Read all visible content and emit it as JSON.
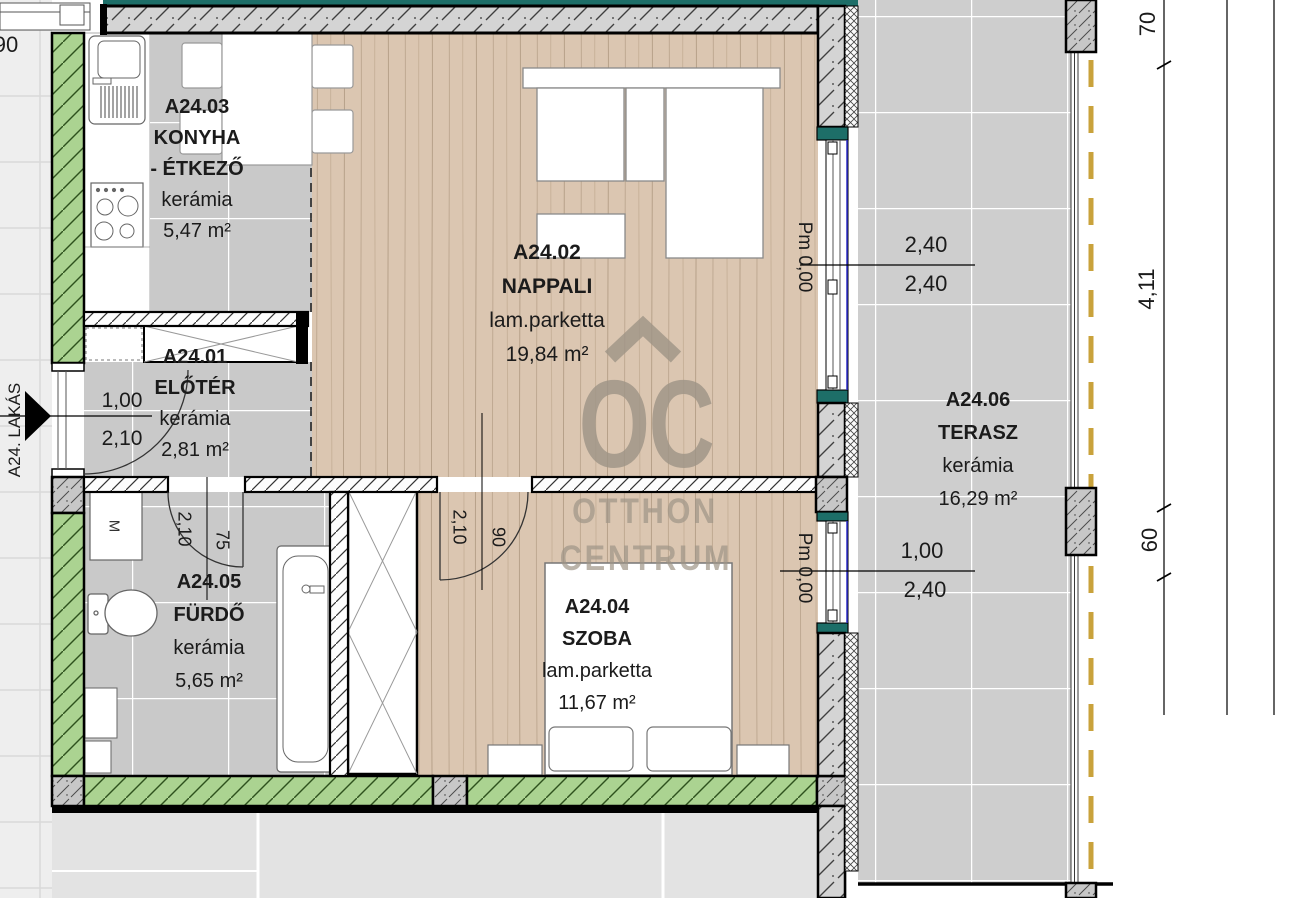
{
  "plan_title": "A24 lakás alaprajz",
  "rooms": {
    "eloter": {
      "id": "A24.01",
      "name": "ELŐTÉR",
      "floor": "kerámia",
      "area": "2,81 m²"
    },
    "nappali": {
      "id": "A24.02",
      "name": "NAPPALI",
      "floor": "lam.parketta",
      "area": "19,84 m²"
    },
    "konyha": {
      "id": "A24.03",
      "name1": "KONYHA",
      "name2": "- ÉTKEZŐ",
      "floor": "kerámia",
      "area": "5,47 m²"
    },
    "szoba": {
      "id": "A24.04",
      "name": "SZOBA",
      "floor": "lam.parketta",
      "area": "11,67 m²"
    },
    "furdo": {
      "id": "A24.05",
      "name": "FÜRDŐ",
      "floor": "kerámia",
      "area": "5,65 m²"
    },
    "terasz": {
      "id": "A24.06",
      "name": "TERASZ",
      "floor": "kerámia",
      "area": "16,29 m²"
    }
  },
  "dims": {
    "window_nappali_w": "2,40",
    "window_nappali_h": "2,40",
    "window_szoba_w": "1,00",
    "window_szoba_h": "2,40",
    "door_entry_w": "1,00",
    "door_entry_h": "2,10",
    "door_furdo_h": "2,10",
    "door_furdo_w": "75",
    "door_szoba_h": "2,10",
    "door_szoba_w": "90",
    "right_top": "70",
    "right_main": "4,11",
    "right_lower": "60",
    "neighbor_partial": "90"
  },
  "levels": {
    "nappali": "Pm 0,00",
    "szoba": "Pm 0,00"
  },
  "entry_label": "A24. LAKÁS",
  "appliances": {
    "washing_machine": "M"
  },
  "watermark": {
    "logo": "OC",
    "line1": "OTTHON",
    "line2": "CENTRUM"
  },
  "colors": {
    "wood_floor": "#dbc6b1",
    "tile_floor": "#c9c9c9",
    "terrace_tile": "#cecece",
    "insulation_green": "#abd391",
    "sill_teal": "#1d6e68",
    "terrace_edge_yellow": "#c9a23b",
    "window_glass_blue": "#2e2ecc",
    "watermark_grey": "#a1968a"
  }
}
